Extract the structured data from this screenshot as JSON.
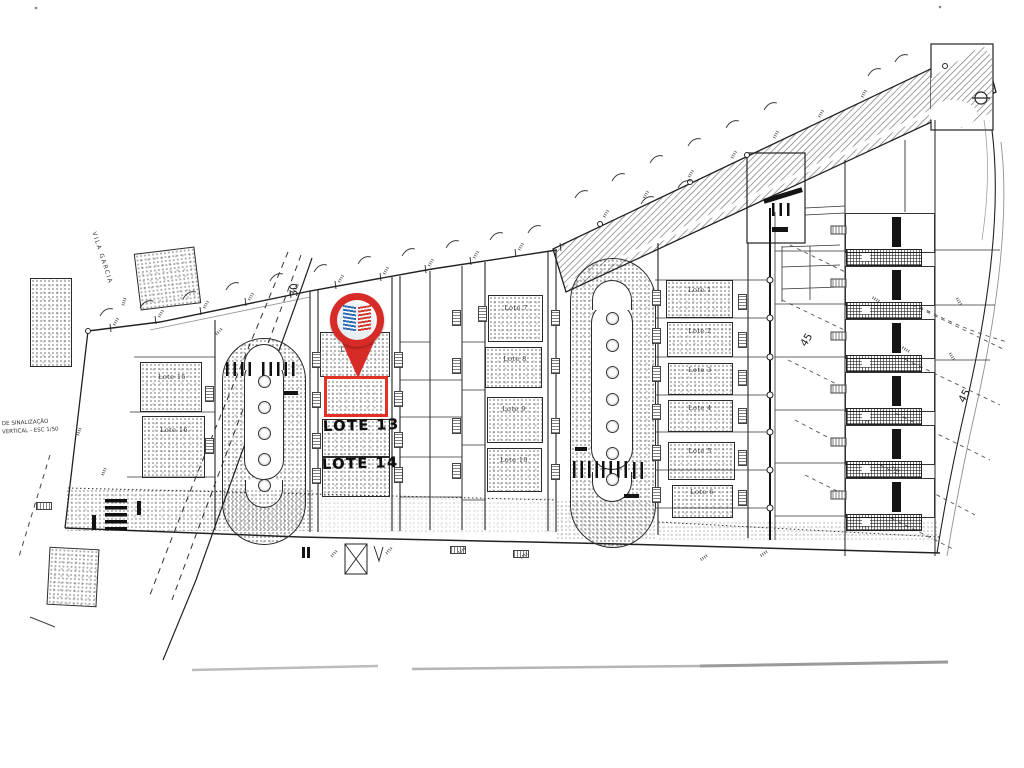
{
  "title": "Planta de loteamento — scanned site plan with highlighted lot",
  "colors": {
    "paper": "#ffffff",
    "ink": "#222222",
    "marker_red": "#d62b27",
    "highlight_red": "#e33127",
    "logo_blue": "#2f6cb5",
    "logo_red": "#cf3b31"
  },
  "marker": {
    "icon": "location-pin-with-logo"
  },
  "street": {
    "name": "VILA GARCIA"
  },
  "dimensions": {
    "top_left": "30",
    "right_mid": "45",
    "right_lower": "45"
  },
  "caption": {
    "line1": "DE SINALIZAÇÃO",
    "line2": "VERTICAL - ESC 1/50"
  },
  "lots": {
    "handwritten": {
      "lote13": "LOTE 13",
      "lote14": "LOTE 14"
    },
    "left_column": {
      "lote15": "Lote 15",
      "lote16": "Lote 16"
    },
    "middle_column": {
      "lote7": "Lote 7",
      "lote8": "Lote 8",
      "lote9": "Lote 9",
      "lote10": "Lote 10"
    },
    "right_column": {
      "lote1": "Lote 1",
      "lote2": "Lote 2",
      "lote3": "Lote 3",
      "lote4": "Lote 4",
      "lote5": "Lote 5",
      "lote6": "Lote 6"
    },
    "pinned": {
      "lote11": "Lote 11"
    }
  }
}
